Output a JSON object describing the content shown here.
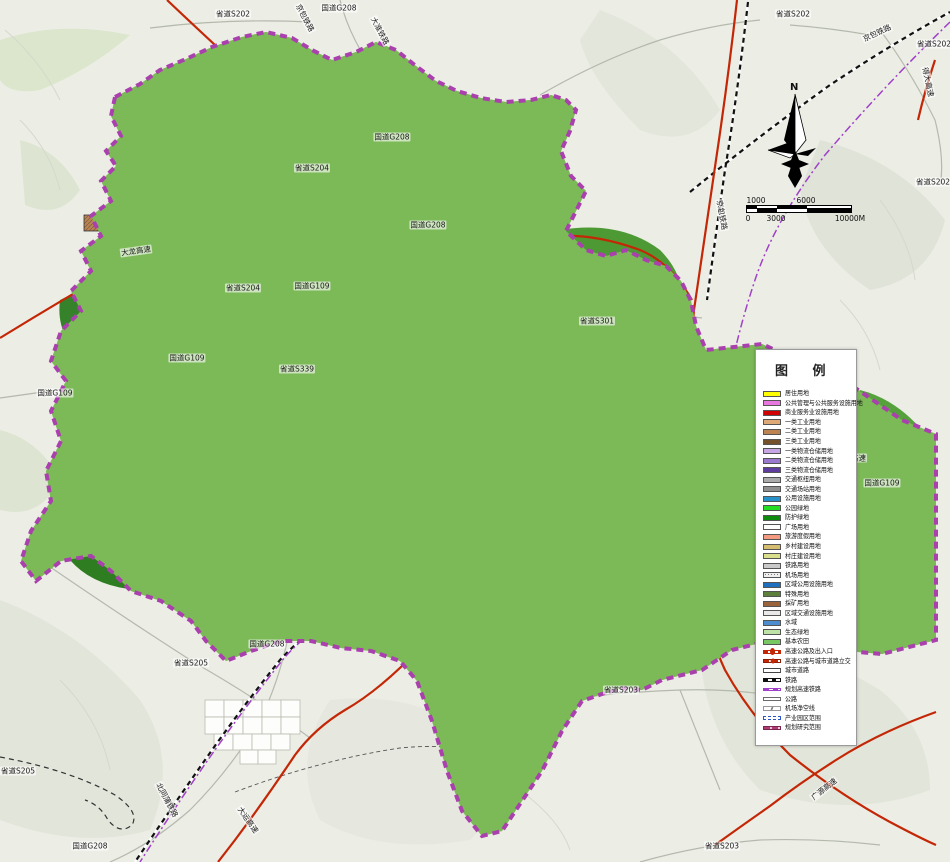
{
  "colors": {
    "boundary_purple": "#aa3fae",
    "expressway_red": "#c32706",
    "railway_black": "#111111",
    "planned_hsr_purple": "#a040c8",
    "water_blue": "#3f86d2",
    "forest_dark_green": "#2e7d20",
    "farmland_green": "#7cb957",
    "residential_yellow": "#efe24e",
    "legend_bg": "#ffffff"
  },
  "compass": {
    "north_label": "N"
  },
  "scale_bar": {
    "top_labels": [
      {
        "text": "1000",
        "pos": 10
      },
      {
        "text": "6000",
        "pos": 60
      }
    ],
    "bottom_labels": [
      {
        "text": "0",
        "pos": 2
      },
      {
        "text": "3000",
        "pos": 30
      },
      {
        "text": "10000M",
        "pos": 104
      }
    ]
  },
  "legend": {
    "title": "图 例",
    "items": [
      {
        "label": "居住用地",
        "swatch": {
          "kind": "fill",
          "color": "#ffff00"
        }
      },
      {
        "label": "公共管理与公共服务设施用地",
        "swatch": {
          "kind": "fill",
          "color": "#e878e0"
        }
      },
      {
        "label": "商业服务业设施用地",
        "swatch": {
          "kind": "fill",
          "color": "#d00000"
        }
      },
      {
        "label": "一类工业用地",
        "swatch": {
          "kind": "fill",
          "color": "#dda977"
        }
      },
      {
        "label": "二类工业用地",
        "swatch": {
          "kind": "fill",
          "color": "#bc8450"
        }
      },
      {
        "label": "三类工业用地",
        "swatch": {
          "kind": "fill",
          "color": "#74512b"
        }
      },
      {
        "label": "一类物流仓储用地",
        "swatch": {
          "kind": "fill",
          "color": "#c6a6e4"
        }
      },
      {
        "label": "二类物流仓储用地",
        "swatch": {
          "kind": "fill",
          "color": "#9a79cf"
        }
      },
      {
        "label": "三类物流仓储用地",
        "swatch": {
          "kind": "fill",
          "color": "#5f3d9e"
        }
      },
      {
        "label": "交通枢纽用地",
        "swatch": {
          "kind": "fill",
          "color": "#ababab"
        }
      },
      {
        "label": "交通场站用地",
        "swatch": {
          "kind": "fill",
          "color": "#8f8f8f"
        }
      },
      {
        "label": "公用设施用地",
        "swatch": {
          "kind": "fill",
          "color": "#2791c9"
        }
      },
      {
        "label": "公园绿地",
        "swatch": {
          "kind": "fill",
          "color": "#22dd22"
        }
      },
      {
        "label": "防护绿地",
        "swatch": {
          "kind": "fill",
          "color": "#0e8a0e"
        }
      },
      {
        "label": "广场用地",
        "swatch": {
          "kind": "fill",
          "color": "#ffffff"
        }
      },
      {
        "label": "旅游度假用地",
        "swatch": {
          "kind": "fill",
          "color": "#f29b7e"
        }
      },
      {
        "label": "乡村建设用地",
        "swatch": {
          "kind": "fill",
          "color": "#d6bc6e"
        }
      },
      {
        "label": "村庄建设用地",
        "swatch": {
          "kind": "fill",
          "color": "#dadf8d"
        }
      },
      {
        "label": "铁路用地",
        "swatch": {
          "kind": "fill",
          "color": "#c9c9c9"
        }
      },
      {
        "label": "机场用地",
        "swatch": {
          "kind": "fill",
          "color": "#efefef",
          "pattern": "dots"
        }
      },
      {
        "label": "区域公用设施用地",
        "swatch": {
          "kind": "fill",
          "color": "#1f6fbe"
        }
      },
      {
        "label": "特殊用地",
        "swatch": {
          "kind": "fill",
          "color": "#5c7f3c"
        }
      },
      {
        "label": "採矿用地",
        "swatch": {
          "kind": "fill",
          "color": "#9a633b"
        }
      },
      {
        "label": "区域交通设施用地",
        "swatch": {
          "kind": "fill",
          "color": "#e9e9e9"
        }
      },
      {
        "label": "水域",
        "swatch": {
          "kind": "fill",
          "color": "#4d8ccf"
        }
      },
      {
        "label": "生态绿地",
        "swatch": {
          "kind": "fill",
          "color": "#bfe3a6"
        }
      },
      {
        "label": "基本农田",
        "swatch": {
          "kind": "fill",
          "color": "#77c763"
        }
      },
      {
        "label": "高速公路及出入口",
        "swatch": {
          "kind": "line",
          "style": "expressway"
        }
      },
      {
        "label": "高速公路与城市道路立交",
        "swatch": {
          "kind": "line",
          "style": "interchange"
        }
      },
      {
        "label": "城市道路",
        "swatch": {
          "kind": "line",
          "style": "city-road"
        }
      },
      {
        "label": "铁路",
        "swatch": {
          "kind": "line",
          "style": "railway"
        }
      },
      {
        "label": "规划高速铁路",
        "swatch": {
          "kind": "line",
          "style": "hsr"
        }
      },
      {
        "label": "公路",
        "swatch": {
          "kind": "line",
          "style": "highway"
        }
      },
      {
        "label": "机场净空线",
        "swatch": {
          "kind": "line",
          "style": "clearance"
        }
      },
      {
        "label": "产业园区范围",
        "swatch": {
          "kind": "line",
          "style": "park-boundary"
        }
      },
      {
        "label": "规划研究范围",
        "swatch": {
          "kind": "line",
          "style": "study-area"
        }
      }
    ]
  },
  "map": {
    "labels": [
      {
        "text": "省道S202",
        "x": 233,
        "y": 14
      },
      {
        "text": "国道G208",
        "x": 339,
        "y": 8
      },
      {
        "text": "京包铁路",
        "x": 305,
        "y": 18,
        "rot": 62
      },
      {
        "text": "大准铁路",
        "x": 380,
        "y": 31,
        "rot": 62
      },
      {
        "text": "省道S202",
        "x": 793,
        "y": 14
      },
      {
        "text": "京包铁路",
        "x": 877,
        "y": 33,
        "rot": -25
      },
      {
        "text": "省道S202",
        "x": 934,
        "y": 44
      },
      {
        "text": "得大高速",
        "x": 928,
        "y": 82,
        "rot": 78
      },
      {
        "text": "省道S202",
        "x": 933,
        "y": 182
      },
      {
        "text": "国道G208",
        "x": 392,
        "y": 137
      },
      {
        "text": "省道S204",
        "x": 312,
        "y": 168
      },
      {
        "text": "国道G208",
        "x": 428,
        "y": 225
      },
      {
        "text": "大龙高速",
        "x": 136,
        "y": 251,
        "rot": -8
      },
      {
        "text": "省道S204",
        "x": 243,
        "y": 288
      },
      {
        "text": "国道G109",
        "x": 312,
        "y": 286
      },
      {
        "text": "省道S301",
        "x": 597,
        "y": 321
      },
      {
        "text": "国道G109",
        "x": 187,
        "y": 358
      },
      {
        "text": "省道S339",
        "x": 297,
        "y": 369
      },
      {
        "text": "国道G109",
        "x": 55,
        "y": 393
      },
      {
        "text": "京包铁路",
        "x": 722,
        "y": 215,
        "rot": 80
      },
      {
        "text": "京大高速",
        "x": 851,
        "y": 458
      },
      {
        "text": "国道G109",
        "x": 882,
        "y": 483
      },
      {
        "text": "国道G208",
        "x": 267,
        "y": 644
      },
      {
        "text": "省道S205",
        "x": 191,
        "y": 663
      },
      {
        "text": "省道S203",
        "x": 621,
        "y": 690
      },
      {
        "text": "省道S205",
        "x": 18,
        "y": 771
      },
      {
        "text": "北同蒲铁路",
        "x": 167,
        "y": 800,
        "rot": 62
      },
      {
        "text": "大运高速",
        "x": 248,
        "y": 820,
        "rot": 55
      },
      {
        "text": "国道G208",
        "x": 90,
        "y": 846
      },
      {
        "text": "省道S203",
        "x": 722,
        "y": 846
      },
      {
        "text": "广源高速",
        "x": 824,
        "y": 789,
        "rot": -38
      }
    ]
  }
}
